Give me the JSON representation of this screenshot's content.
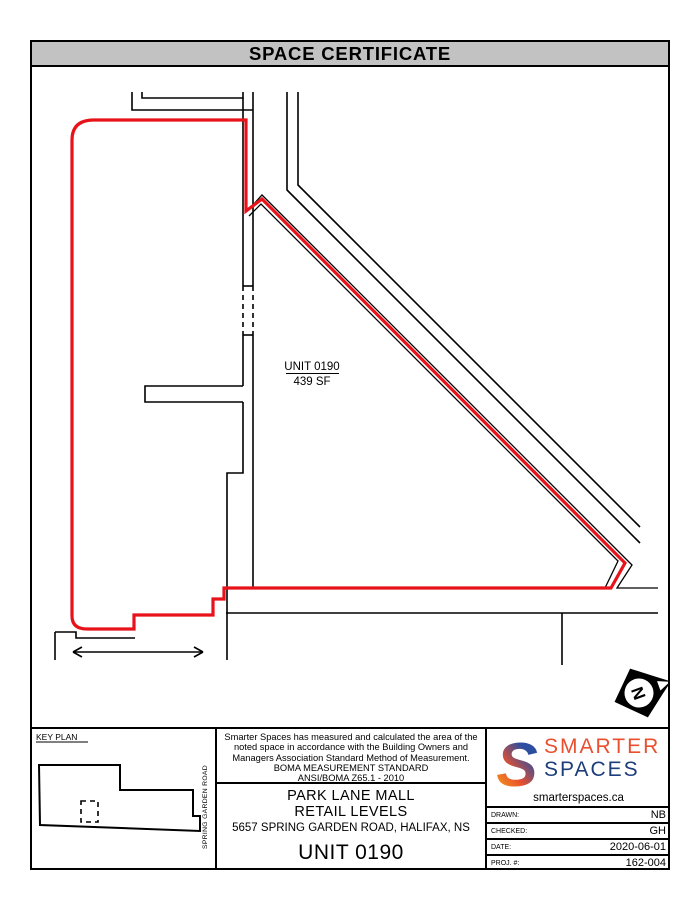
{
  "title": "SPACE CERTIFICATE",
  "colors": {
    "header_bg": "#c2c2c2",
    "boundary_red": "#e8131a",
    "line_black": "#000000",
    "logo_orange": "#e8502f",
    "logo_navy": "#1e3d7b",
    "logo_gradient_blue": "#2b4ea0",
    "logo_gradient_orange": "#f26722"
  },
  "plan": {
    "unit_label": "UNIT 0190",
    "unit_area": "439 SF",
    "north_letter": "N"
  },
  "key_plan": {
    "label": "KEY PLAN",
    "street": "SPRING GARDEN ROAD"
  },
  "statement": {
    "line1": "Smarter Spaces has measured and calculated the area of the",
    "line2": "noted space in accordance with the Building Owners and",
    "line3": "Managers Association Standard Method of Measurement.",
    "line4": "BOMA MEASUREMENT STANDARD",
    "line5": "ANSI/BOMA Z65.1 - 2010"
  },
  "project": {
    "building": "PARK LANE MALL",
    "level": "RETAIL LEVELS",
    "address": "5657 SPRING GARDEN ROAD, HALIFAX, NS",
    "unit": "UNIT 0190"
  },
  "branding": {
    "logo_s": "S",
    "word1": "SMARTER",
    "word2": "SPACES",
    "website": "smarterspaces.ca"
  },
  "title_block": {
    "rows": [
      {
        "label": "DRAWN:",
        "value": "NB"
      },
      {
        "label": "CHECKED:",
        "value": "GH"
      },
      {
        "label": "DATE:",
        "value": "2020-06-01"
      },
      {
        "label": "PROJ. #:",
        "value": "162-004"
      }
    ]
  }
}
